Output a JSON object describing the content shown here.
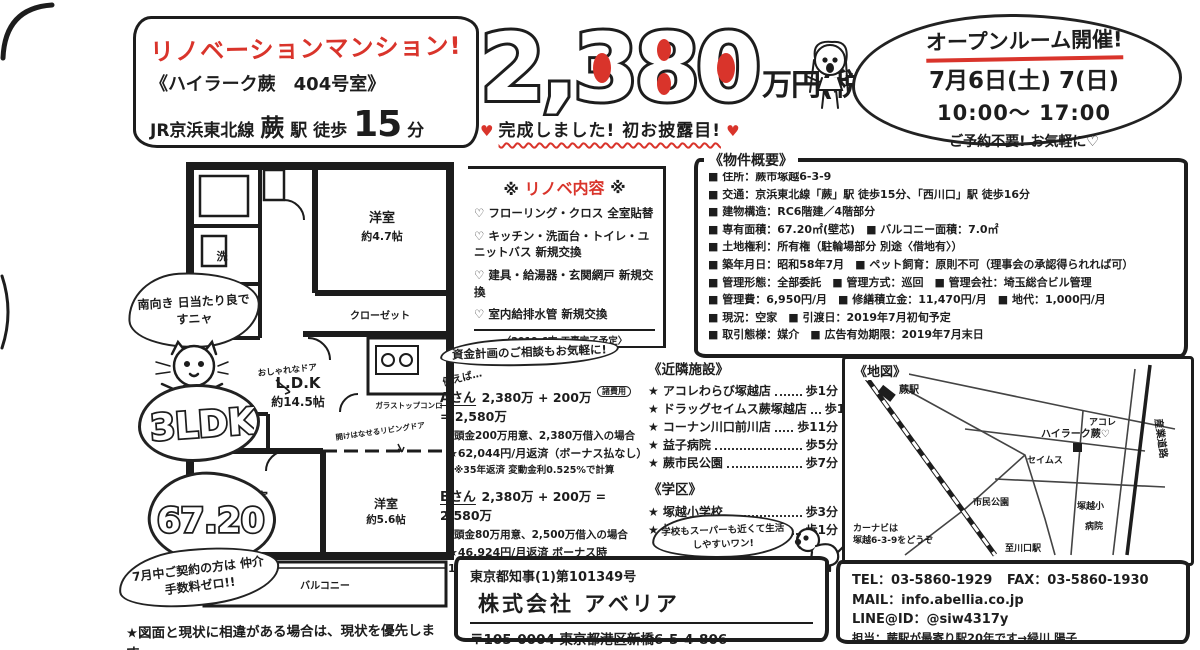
{
  "title_box": {
    "main": "リノベーションマンション!",
    "sub": "《ハイラーク蕨　404号室》",
    "line_prefix": "JR京浜東北線",
    "station": "蕨",
    "eki": "駅 徒歩",
    "minutes": "15",
    "unit": "分"
  },
  "price": {
    "amount": "2,380",
    "unit": "万円(税込)",
    "heart": "♥",
    "banner": "完成しました! 初お披露目!"
  },
  "openroom": {
    "title": "オープンルーム開催!",
    "date": "7月6日(土) 7(日)",
    "time": "10:00〜 17:00",
    "note": "ご予約不要! お気軽に♡"
  },
  "renovation": {
    "header_left": "※",
    "header": "リノベ内容",
    "header_right": "※",
    "items": [
      "♡ フローリング・クロス 全室貼替",
      "♡ キッチン・洗面台・トイレ・ユニットバス 新規交換",
      "♡ 建具・給湯器・玄関網戸 新規交換",
      "♡ 室内給排水管 新規交換"
    ],
    "footnote": "〈2019.6末 工事完了予定〉"
  },
  "overview": {
    "header": "《物件概要》",
    "rows": [
      "■ 住所：蕨市塚越6-3-9",
      "■ 交通：京浜東北線「蕨」駅 徒歩15分、「西川口」駅 徒歩16分",
      "■ 建物構造：RC6階建／4階部分",
      "■ 専有面積：67.20㎡(壁芯)　■ バルコニー面積：7.0㎡",
      "■ 土地権利：所有権（駐輪場部分 別途〈借地有〉）",
      "■ 築年月日：昭和58年7月　■ ペット飼育：原則不可（理事会の承認得られれば可）",
      "■ 管理形態：全部委託　■ 管理方式：巡回　■ 管理会社：埼玉総合ビル管理",
      "■ 管理費：6,950円/月　■ 修繕積立金：11,470円/月　■ 地代：1,000円/月",
      "■ 現況：空家　■ 引渡日：2019年7月初旬予定",
      "■ 取引態様：媒介　■ 広告有効期限：2019年7月末日"
    ]
  },
  "funding": {
    "header": "資金計画のご相談もお気軽に!",
    "lead": "例えば…",
    "a": {
      "name": "Aさん",
      "formula": "2,380万 + 200万",
      "tag": "諸費用",
      "result": "= 2,580万",
      "cond": "頭金200万用意、2,380万借入の場合",
      "pay": "★62,044円/月返済（ボーナス払なし）",
      "note": "※35年返済 変動金利0.525%で計算"
    },
    "b": {
      "name": "Bさん",
      "formula": "2,380万 + 200万 = 2,580万",
      "cond": "頭金80万用意、2,500万借入の場合",
      "pay": "★46,924円/月返済 ボーナス時109,400円/回",
      "note": "※35年返済 変動金利0.525%で計算"
    }
  },
  "nearby": {
    "header": "《近隣施設》",
    "items": [
      {
        "name": "★ アコレわらび塚越店",
        "walk": "歩1分"
      },
      {
        "name": "★ ドラッグセイムス蕨塚越店",
        "walk": "歩1分"
      },
      {
        "name": "★ コーナン川口前川店",
        "walk": "歩11分"
      },
      {
        "name": "★ 益子病院",
        "walk": "歩5分"
      },
      {
        "name": "★ 蕨市民公園",
        "walk": "歩7分"
      }
    ]
  },
  "school": {
    "header": "《学区》",
    "items": [
      {
        "name": "★ 塚越小学校",
        "walk": "歩3分"
      },
      {
        "name": "★ 塚越中学校",
        "walk": "歩1分"
      }
    ]
  },
  "dog_bubble": {
    "text": "学校もスーパーも近くて生活しやすいワン!"
  },
  "plan": {
    "room1": "洋室",
    "room1_size": "約4.7帖",
    "closet1": "クローゼット",
    "ldk": "L.D.K",
    "ldk_size": "約14.5帖",
    "closet2": "クローゼット",
    "room2": "洋室",
    "room2_size": "約5帖",
    "room3": "洋室",
    "room3_size": "約5.6帖",
    "balcony": "バルコニー",
    "wash": "洗",
    "stove_note": "ガラストップコンロ",
    "door_note": "おしゃれなドア",
    "living_door_note": "開けはなせるリビングドア"
  },
  "bubbles": {
    "south": "南向き 日当たり良ですニャ",
    "ldk": "3LDK",
    "size": "67.20",
    "campaign": "7月中ご契約の方は 仲介手数料ゼロ!!"
  },
  "map": {
    "title": "《地図》",
    "labels": {
      "station": "蕨駅",
      "road": "産業道路",
      "property": "ハイラーク蕨♡",
      "shop1": "セイムス",
      "shop2": "アコレ",
      "park": "市民公園",
      "school": "塚越小",
      "hospital": "病院",
      "note1": "カーナビは",
      "note2": "塚越6-3-9をどうぞ",
      "dir": "至川口駅"
    }
  },
  "company": {
    "license": "東京都知事(1)第101349号",
    "name": "株式会社 アベリア",
    "address": "〒105-0004 東京都港区新橋6-5-4-806"
  },
  "contact": {
    "tel": "TEL：03-5860-1929",
    "fax": "FAX：03-5860-1930",
    "mail": "MAIL：info.abellia.co.jp",
    "line": "LINE@ID：@siw4317y",
    "person": "担当：蕨駅が最寄り駅20年です→緑川 陽子"
  },
  "footer": {
    "note": "★図面と現状に相違がある場合は、現状を優先します。"
  }
}
